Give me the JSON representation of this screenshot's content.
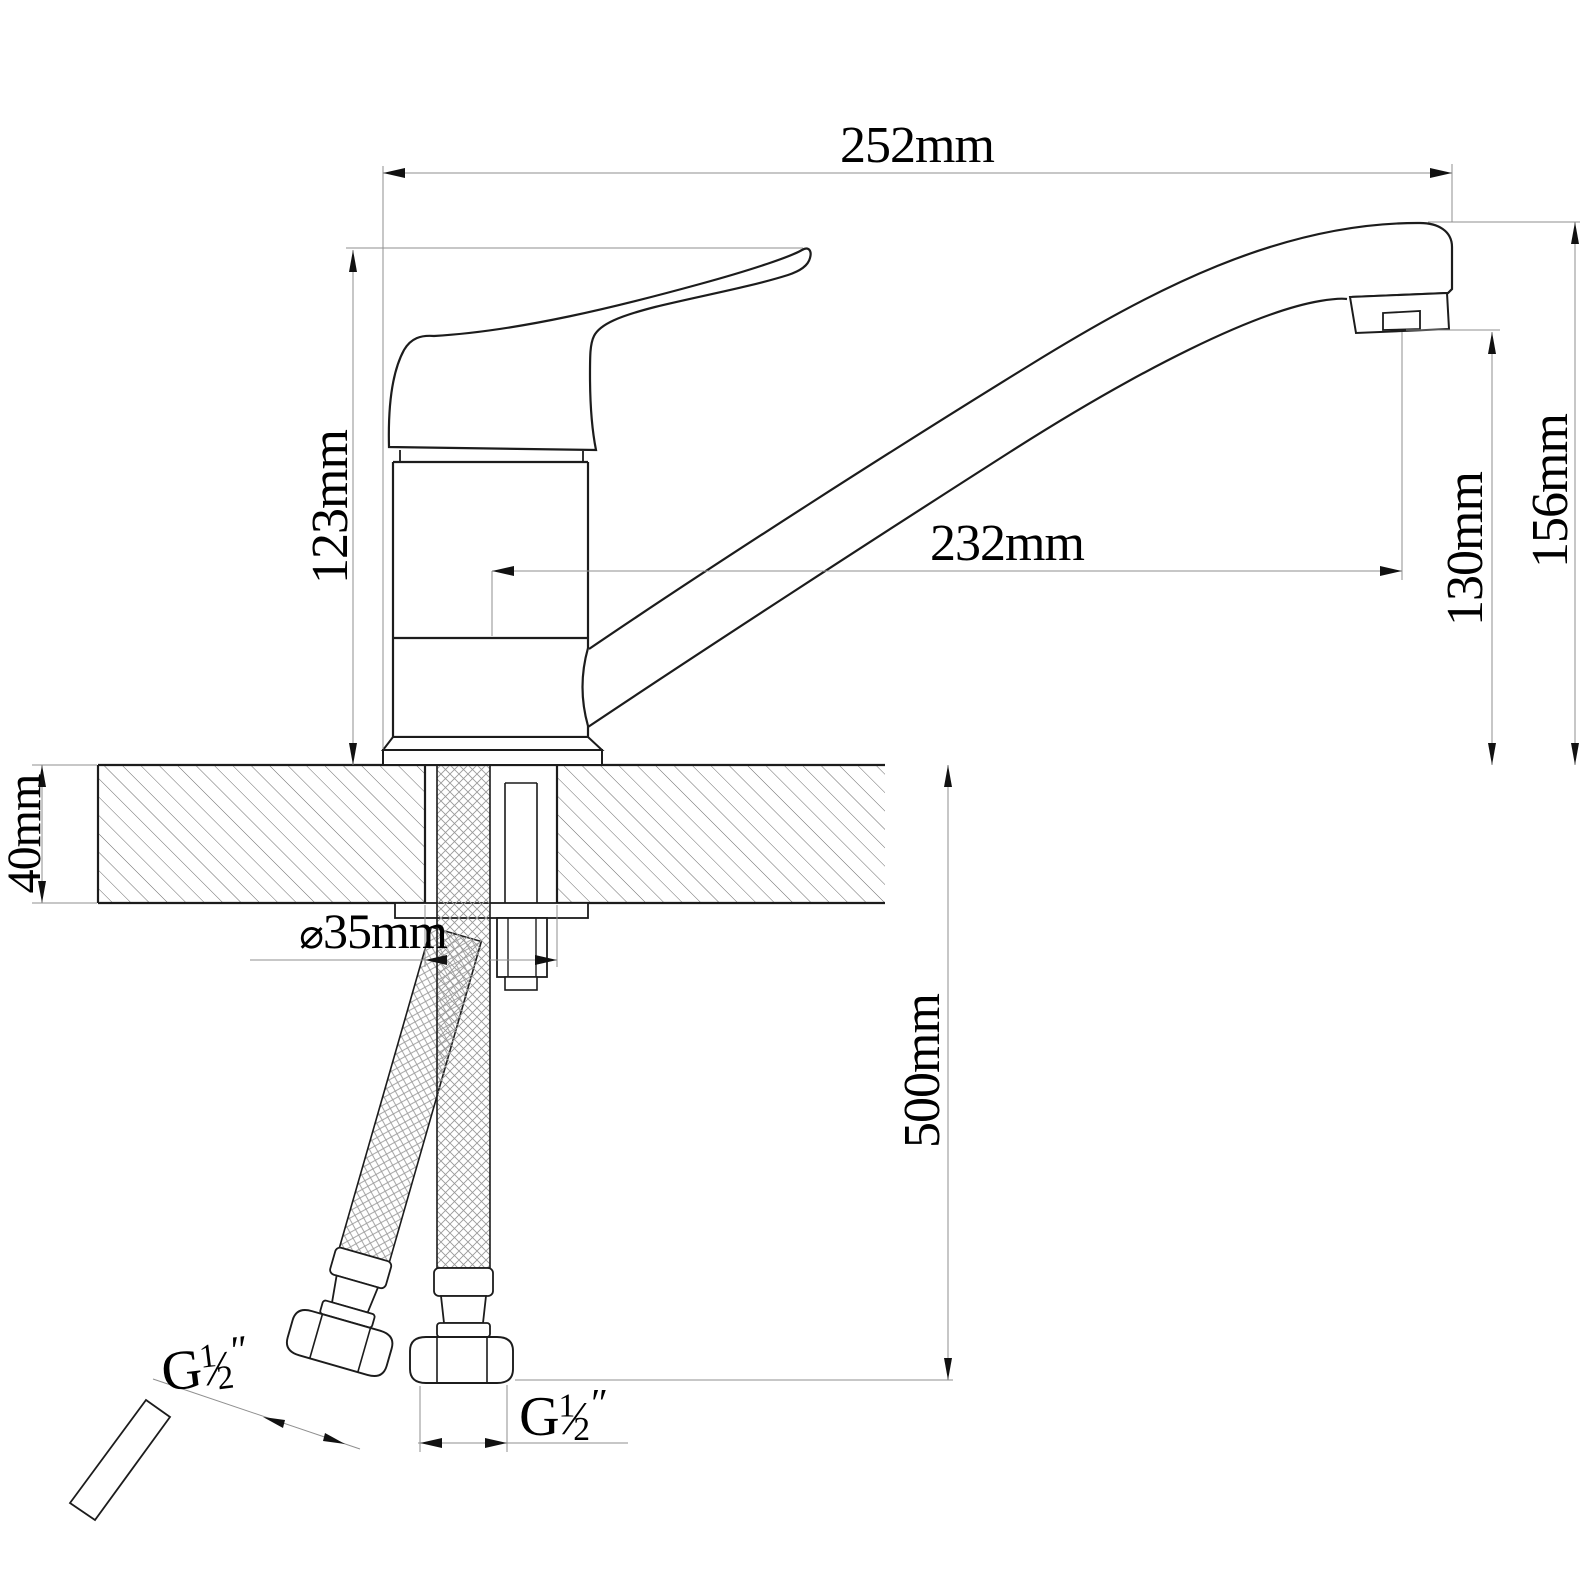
{
  "colors": {
    "outline": "#1c1c1c",
    "dimension_line": "#8f8f8f",
    "text": "#000000",
    "background": "#ffffff"
  },
  "drawing": {
    "labels": {
      "overall_length": "252mm",
      "body_height": "123mm",
      "spout_reach": "232mm",
      "outlet_height": "130mm",
      "spout_top_height": "156mm",
      "deck_thickness": "40mm",
      "hole_diameter": {
        "symbol": "⌀",
        "value": "35mm"
      },
      "hose_length": "500mm",
      "thread_angled": {
        "prefix": "G",
        "numerator": "1",
        "denominator": "2",
        "suffix": "″"
      },
      "thread_vertical": {
        "prefix": "G",
        "numerator": "1",
        "denominator": "2",
        "suffix": "″"
      }
    }
  }
}
